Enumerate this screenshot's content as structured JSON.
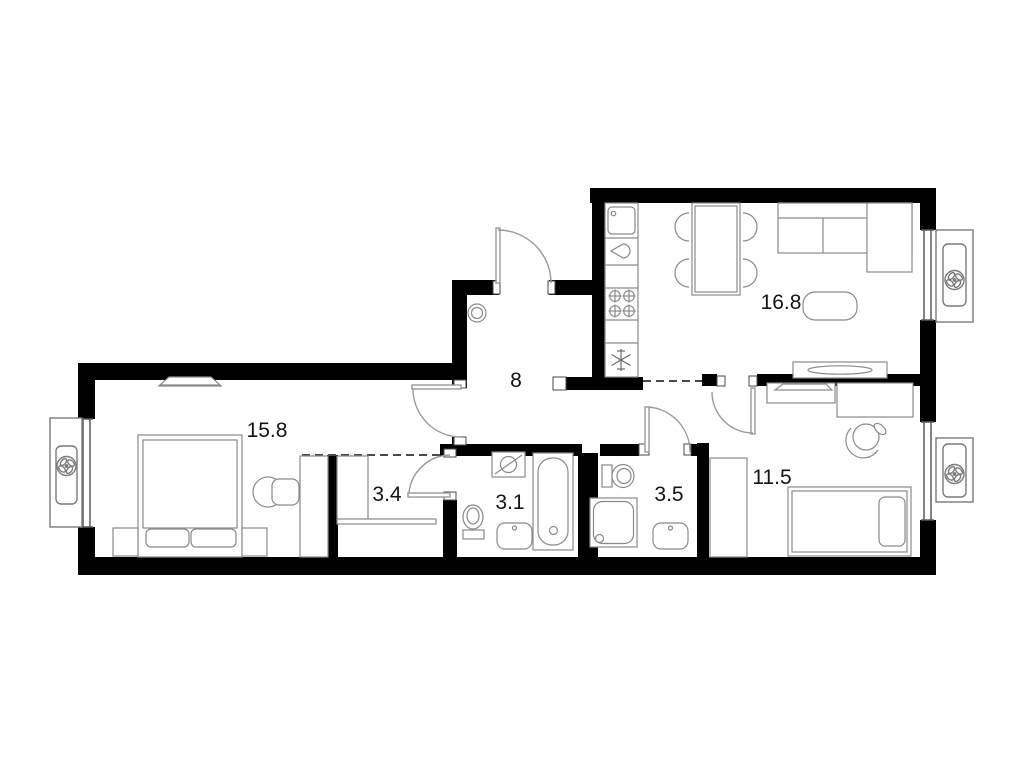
{
  "plan": {
    "type": "apartment-floor-plan",
    "rooms": [
      {
        "name": "hallway",
        "area": "8"
      },
      {
        "name": "master-bedroom",
        "area": "15.8"
      },
      {
        "name": "walk-in-closet",
        "area": "3.4"
      },
      {
        "name": "bathroom",
        "area": "3.1"
      },
      {
        "name": "shower-room",
        "area": "3.5"
      },
      {
        "name": "kitchen-living-room",
        "area": "16.8"
      },
      {
        "name": "bedroom",
        "area": "11.5"
      }
    ],
    "colors": {
      "wall": "#000000",
      "background": "#ffffff",
      "furniture_line": "#8a8a8a",
      "door_line": "#9a9a9a",
      "text": "#141414"
    }
  }
}
